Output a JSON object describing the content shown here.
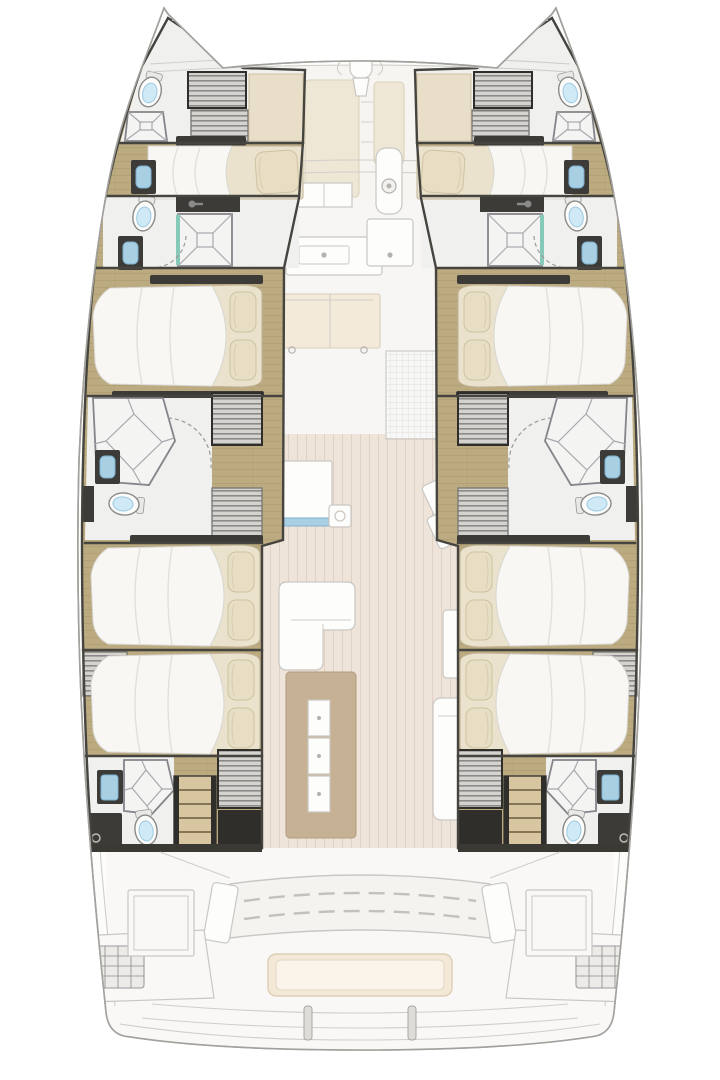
{
  "diagram": {
    "title": "Catamaran accommodation and deck floor plan, bow up",
    "type": "boat-floorplan",
    "orientation": "bow-up"
  },
  "palette": {
    "dark_furniture": "#3c3b37",
    "wood_floor": "#bcab81",
    "wood_line": "#96855c",
    "locker_cream": "#e9dfc8",
    "shower": "#f4f4f2",
    "toilet_water": "#cfe9f6",
    "sink_blue": "#a9cfe2",
    "mattress": "#eae2cd",
    "duvet": "#f8f7f4",
    "pillow": "#e8dec3",
    "cockpit_floor": "#efe4d9",
    "table_tan": "#c7b194",
    "bench_cream": "#f3e9d6"
  },
  "totals": {
    "guest_cabins": 6,
    "crew_cabins": 2,
    "berths": 8,
    "bathrooms": 6,
    "companionway_stairs": 4
  },
  "port_hull": {
    "label": "Port hull accommodation",
    "cabins": [
      {
        "name": "bow crew cabin",
        "features": [
          "single berth",
          "toilet",
          "shower pan",
          "louvered lockers",
          "cream locker",
          "washbasin"
        ]
      },
      {
        "name": "forward guest cabin",
        "features": [
          "island double bed with two pillows",
          "en-suite with square shower, toilet, washbasin"
        ]
      },
      {
        "name": "midship bathroom",
        "features": [
          "corner shower cubicle",
          "washbasin",
          "toilet",
          "companionway stairs"
        ]
      },
      {
        "name": "mid guest cabin",
        "features": [
          "island double bed with two pillows"
        ]
      },
      {
        "name": "aft guest cabin",
        "features": [
          "island double bed with two pillows",
          "louvered wardrobe"
        ]
      },
      {
        "name": "aft bathroom",
        "features": [
          "corner shower cubicle",
          "toilet",
          "vanity",
          "hull window",
          "stairs to deck",
          "louvered locker"
        ]
      }
    ]
  },
  "starboard_hull": {
    "label": "Starboard hull accommodation (mirror of port)",
    "cabins": [
      {
        "name": "bow crew cabin",
        "features": [
          "single berth",
          "toilet",
          "shower pan",
          "louvered lockers"
        ]
      },
      {
        "name": "forward guest cabin",
        "features": [
          "island double bed",
          "en-suite shower room"
        ]
      },
      {
        "name": "midship bathroom",
        "features": [
          "corner shower",
          "washbasin",
          "toilet",
          "stairs"
        ]
      },
      {
        "name": "mid guest cabin",
        "features": [
          "island double bed"
        ]
      },
      {
        "name": "aft guest cabin",
        "features": [
          "island double bed"
        ]
      },
      {
        "name": "aft bathroom",
        "features": [
          "corner shower",
          "toilet",
          "vanity",
          "stairs"
        ]
      }
    ]
  },
  "main_deck": {
    "label": "Main deck shown faded",
    "foredeck": {
      "label": "Foredeck",
      "features": [
        "crossbeam",
        "anchor roller fitting",
        "sun pads",
        "walkway"
      ]
    },
    "salon": {
      "label": "Salon and galley",
      "features": [
        "windshield",
        "mast post",
        "galley counter with sink",
        "service counter",
        "sideboard cabinet",
        "tiled mat",
        "island unit",
        "floor hatch",
        "two angled seats"
      ]
    },
    "dining": {
      "label": "Open cockpit dining",
      "features": [
        "L-shaped sofa",
        "extending table with three leaves",
        "chaise bench",
        "side table"
      ]
    },
    "aft_cockpit": {
      "label": "Aft cockpit",
      "features": [
        "curved slatted bench",
        "cream settee",
        "two consoles with vents",
        "two deck hatches",
        "transom platform steps"
      ]
    }
  }
}
